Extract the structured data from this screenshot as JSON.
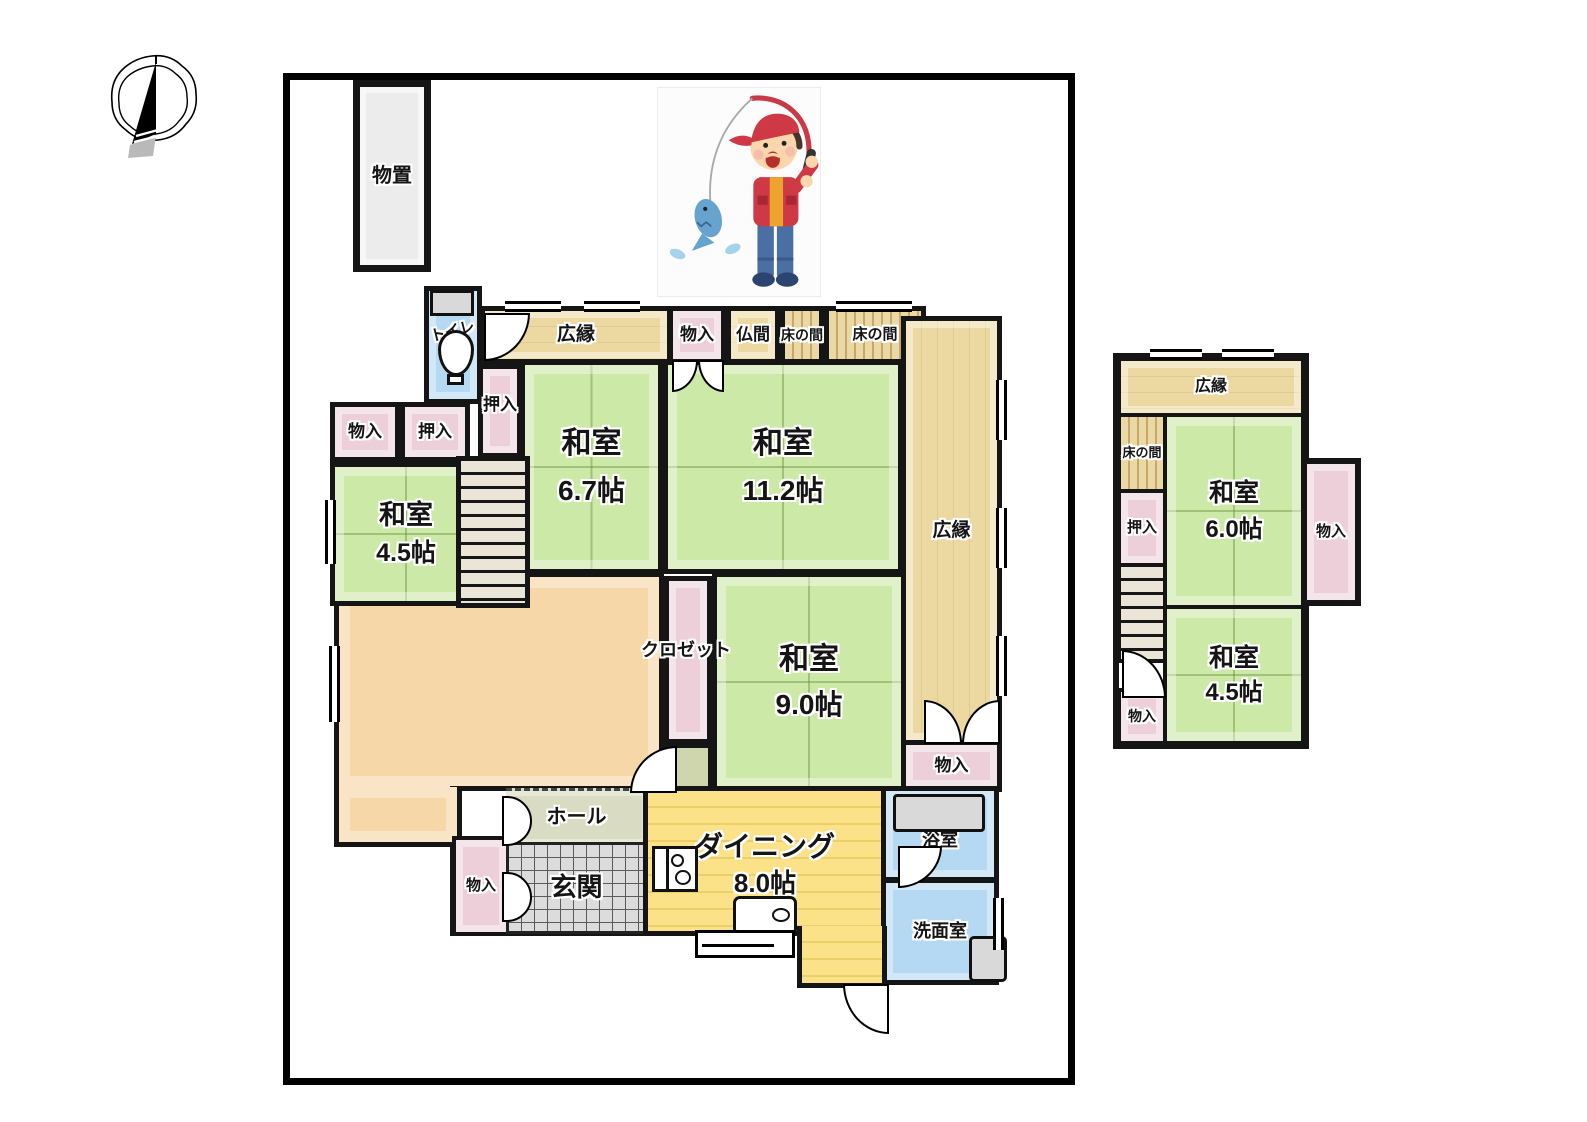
{
  "icons": {
    "compass": "north-compass-icon",
    "illustration": "fishing-boy-illustration",
    "toilet_fixture": "toilet-icon",
    "bathtub": "bathtub-icon",
    "washing_machine": "washing-machine-icon",
    "stove": "stove-icon",
    "sink": "kitchen-sink-icon"
  },
  "colors": {
    "tatami_green": "#cde9a8",
    "veranda_tan": "#ecd9a2",
    "closet_pink": "#eccfd9",
    "water_blue": "#b5d9f2",
    "living_orange": "#f6d7a8",
    "dining_yellow": "#fbe288",
    "hall_gray_green": "#d9dcc3",
    "tile_gray": "#dcdcdc",
    "shed_gray": "#ececec",
    "wall_black": "#151515"
  },
  "floor1": {
    "shed": "物置",
    "toilet": "トイレ",
    "veranda_top": "広縁",
    "storage_top": "物入",
    "butsuma": "仏間",
    "tokonoma_small": "床の間",
    "tokonoma_large": "床の間",
    "veranda_right": "広縁",
    "storage_veranda": "物入",
    "oshiire_center": "押入",
    "storage_left": "物入",
    "oshiire_left": "押入",
    "washitsu_45": {
      "name": "和室",
      "size": "4.5帖"
    },
    "washitsu_67": {
      "name": "和室",
      "size": "6.7帖"
    },
    "washitsu_112": {
      "name": "和室",
      "size": "11.2帖"
    },
    "washitsu_90": {
      "name": "和室",
      "size": "9.0帖"
    },
    "closet": "クロゼット",
    "hall": "ホール",
    "entrance": "玄関",
    "storage_entrance": "物入",
    "dining": {
      "name": "ダイニング",
      "size": "8.0帖"
    },
    "bathroom": "浴室",
    "washroom": "洗面室"
  },
  "floor2": {
    "veranda": "広縁",
    "tokonoma": "床の間",
    "washitsu_60": {
      "name": "和室",
      "size": "6.0帖"
    },
    "oshiire": "押入",
    "storage_right": "物入",
    "storage_bottom": "物入",
    "washitsu_45": {
      "name": "和室",
      "size": "4.5帖"
    }
  }
}
